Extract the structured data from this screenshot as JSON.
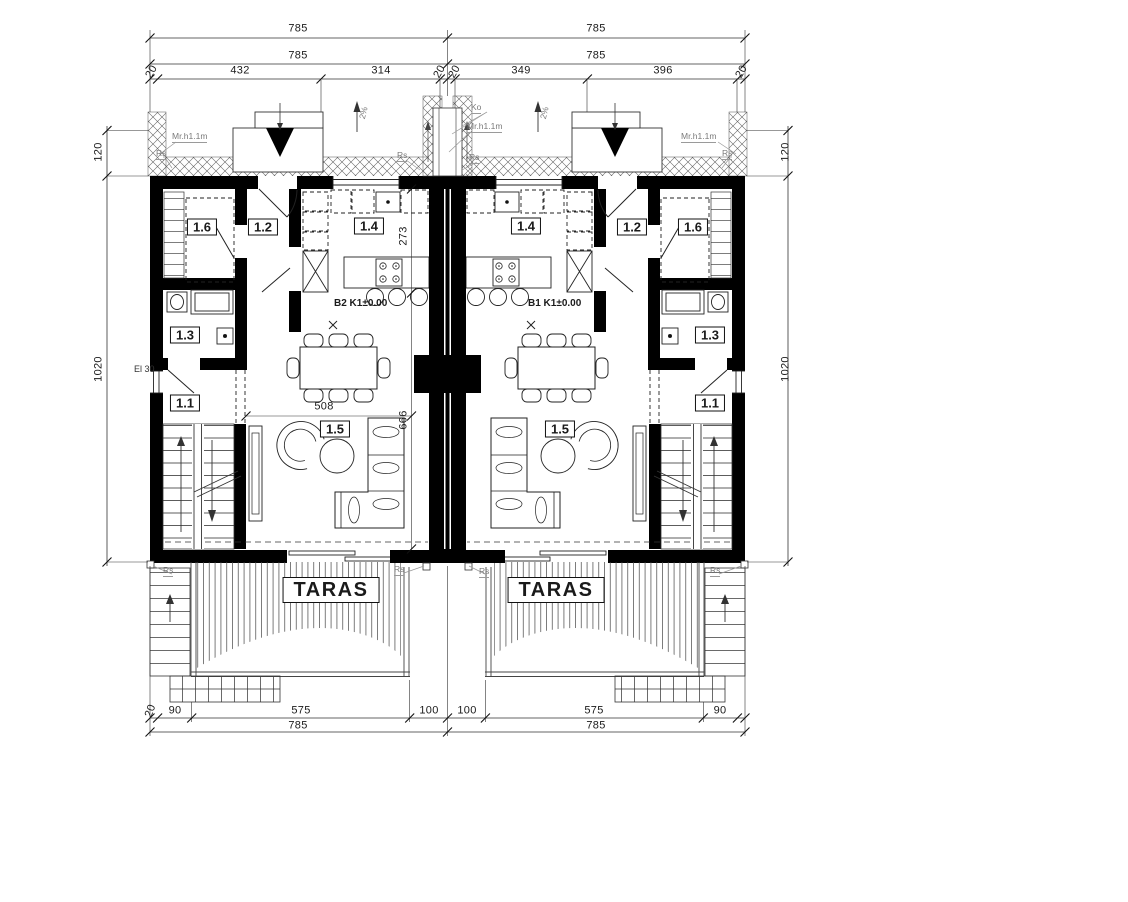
{
  "dims_top": {
    "row1": [
      "785",
      "785"
    ],
    "row2": [
      "785",
      "785"
    ],
    "row3": [
      "20",
      "432",
      "314",
      "20",
      "20",
      "349",
      "396",
      "20"
    ]
  },
  "dims_bottom": {
    "row1": [
      "20",
      "90",
      "575",
      "100",
      "100",
      "575",
      "90"
    ],
    "row2": [
      "785",
      "785"
    ]
  },
  "dims_side": {
    "upper": "120",
    "lower": "1020"
  },
  "dims_interior": {
    "kitchen_depth": "273",
    "living_width": "508",
    "living_depth": "666"
  },
  "rooms": {
    "left": {
      "r16": "1.6",
      "r12": "1.2",
      "r14": "1.4",
      "r13": "1.3",
      "r11": "1.1",
      "r15": "1.5"
    },
    "right": {
      "r16": "1.6",
      "r12": "1.2",
      "r14": "1.4",
      "r13": "1.3",
      "r11": "1.1",
      "r15": "1.5"
    }
  },
  "levels": {
    "left": "B2 K1±0.00",
    "right": "B1 K1±0.00"
  },
  "terrace": {
    "left": "TARAS",
    "right": "TARAS"
  },
  "annotations": {
    "mr": "Mr.h1.1m",
    "rs": "Rs",
    "ko": "Ko",
    "slope": "2%",
    "el": "El 30"
  }
}
